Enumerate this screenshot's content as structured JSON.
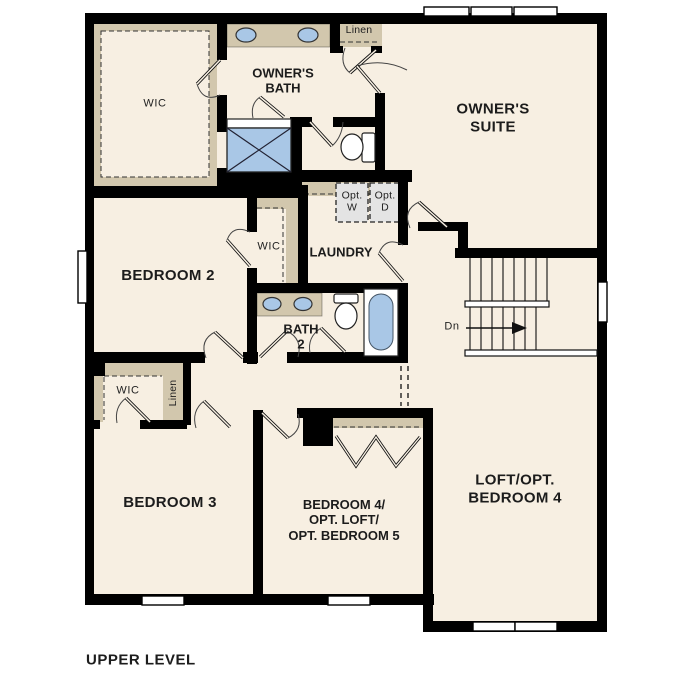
{
  "plan": {
    "level_title": "UPPER LEVEL",
    "rooms": {
      "owners_wic": "WIC",
      "owners_bath": "OWNER'S\nBATH",
      "linen_upper": "Linen",
      "owners_suite": "OWNER'S\nSUITE",
      "opt_washer": "Opt.\nW",
      "opt_dryer": "Opt.\nD",
      "laundry": "LAUNDRY",
      "bedroom2_wic": "WIC",
      "bedroom2": "BEDROOM 2",
      "bath2": "BATH\n2",
      "stairs_down": "Dn",
      "bedroom3_wic": "WIC",
      "linen_lower": "Linen",
      "bedroom3": "BEDROOM 3",
      "bedroom4": "BEDROOM 4/\nOPT. LOFT/\nOPT. BEDROOM 5",
      "loft": "LOFT/OPT.\nBEDROOM 4"
    },
    "colors": {
      "background": "#ffffff",
      "floor": "#f7efe2",
      "wall": "#000000",
      "closet_shelf": "#d2c7ad",
      "fixture_blue": "#a9c7e6",
      "optional_appliance_fill": "#e4e4e4"
    }
  }
}
